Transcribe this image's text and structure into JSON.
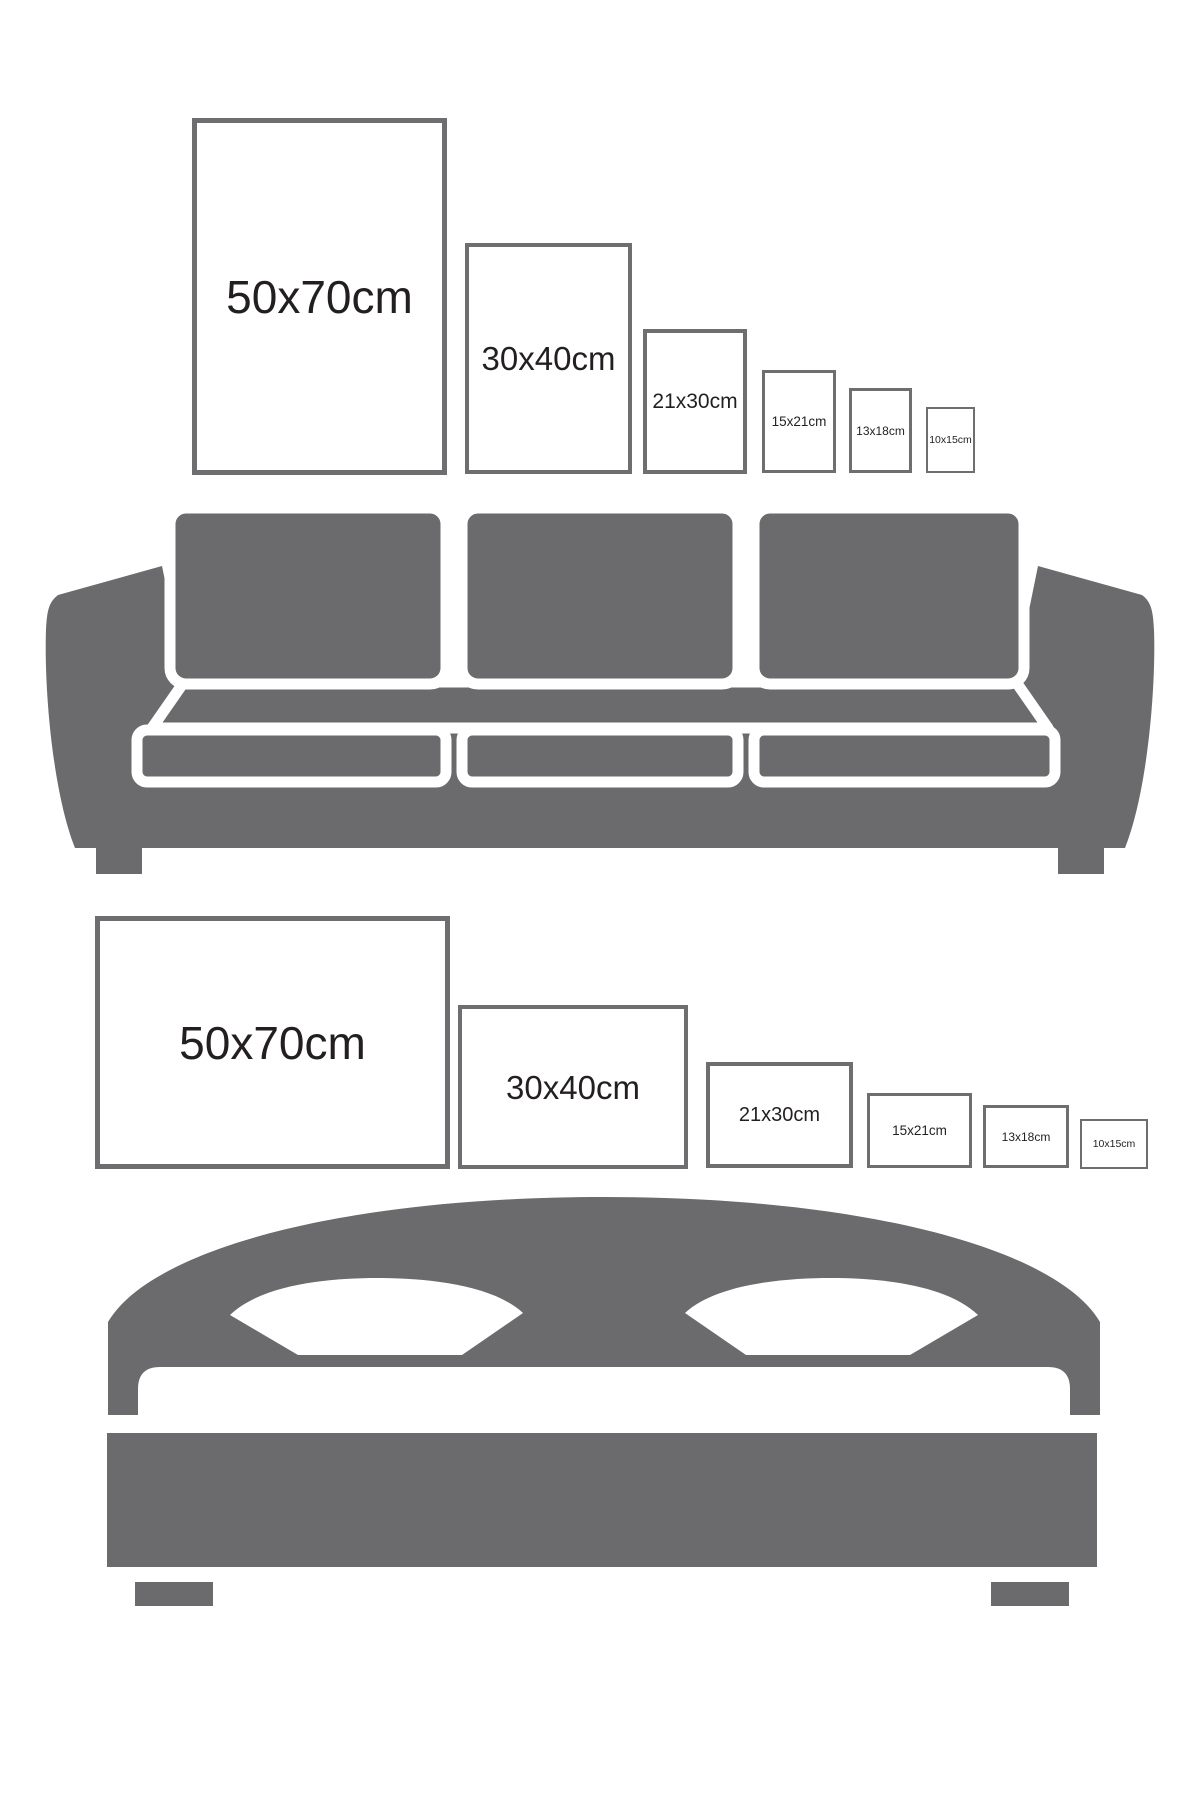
{
  "colors": {
    "background": "#ffffff",
    "furniture_gray": "#6b6a6c",
    "frame_border": "#6e6d6f",
    "label_text": "#231f20"
  },
  "sofa_section": {
    "icon": "sofa-icon",
    "description": "portrait picture frames size comparison above a sofa",
    "frames": [
      {
        "label": "50x70cm",
        "width_cm": 50,
        "height_cm": 70,
        "orientation": "portrait"
      },
      {
        "label": "30x40cm",
        "width_cm": 30,
        "height_cm": 40,
        "orientation": "portrait"
      },
      {
        "label": "21x30cm",
        "width_cm": 21,
        "height_cm": 30,
        "orientation": "portrait"
      },
      {
        "label": "15x21cm",
        "width_cm": 15,
        "height_cm": 21,
        "orientation": "portrait"
      },
      {
        "label": "13x18cm",
        "width_cm": 13,
        "height_cm": 18,
        "orientation": "portrait"
      },
      {
        "label": "10x15cm",
        "width_cm": 10,
        "height_cm": 15,
        "orientation": "portrait"
      }
    ]
  },
  "bed_section": {
    "icon": "bed-icon",
    "description": "landscape picture frames size comparison above a bed",
    "frames": [
      {
        "label": "50x70cm",
        "width_cm": 70,
        "height_cm": 50,
        "orientation": "landscape"
      },
      {
        "label": "30x40cm",
        "width_cm": 40,
        "height_cm": 30,
        "orientation": "landscape"
      },
      {
        "label": "21x30cm",
        "width_cm": 30,
        "height_cm": 21,
        "orientation": "landscape"
      },
      {
        "label": "15x21cm",
        "width_cm": 21,
        "height_cm": 15,
        "orientation": "landscape"
      },
      {
        "label": "13x18cm",
        "width_cm": 18,
        "height_cm": 13,
        "orientation": "landscape"
      },
      {
        "label": "10x15cm",
        "width_cm": 15,
        "height_cm": 10,
        "orientation": "landscape"
      }
    ]
  }
}
